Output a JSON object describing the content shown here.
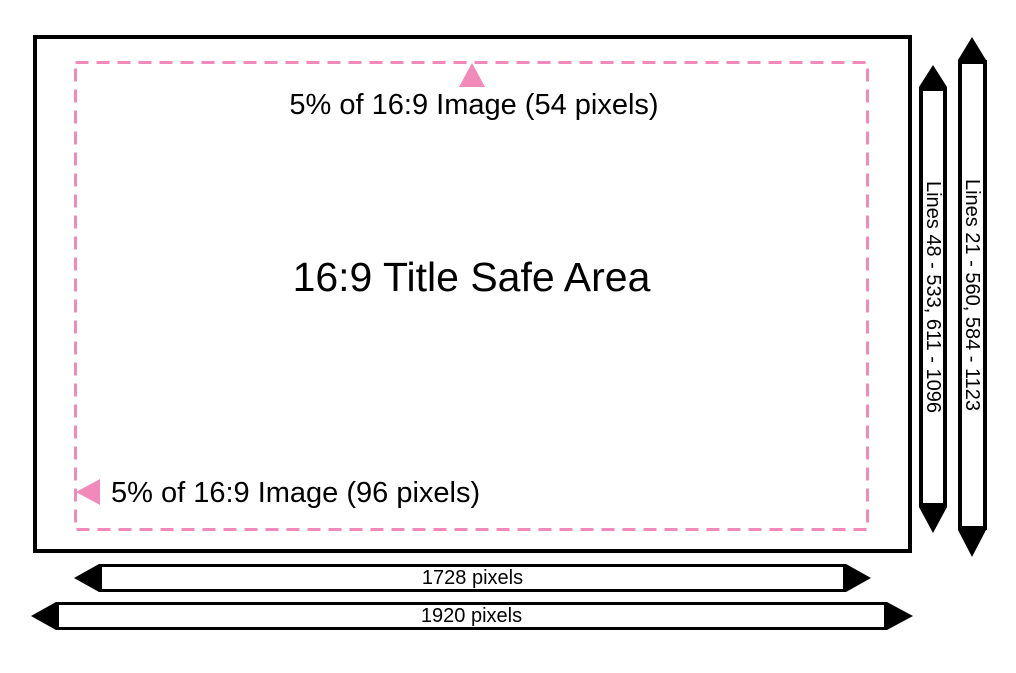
{
  "diagram": {
    "title": "16:9 Title Safe Area",
    "annotations": {
      "top_margin": "5% of 16:9 Image (54 pixels)",
      "left_margin": "5% of 16:9 Image (96 pixels)"
    },
    "vertical_rulers": {
      "safe_lines": "Lines 48 - 533, 611 - 1096",
      "full_lines": "Lines 21 - 560, 584 - 1123"
    },
    "horizontal_rulers": {
      "safe_width": "1728 pixels",
      "full_width": "1920 pixels"
    },
    "colors": {
      "accent_pink": "#F28AB9",
      "outline": "#000000",
      "background": "#FFFFFF"
    }
  }
}
